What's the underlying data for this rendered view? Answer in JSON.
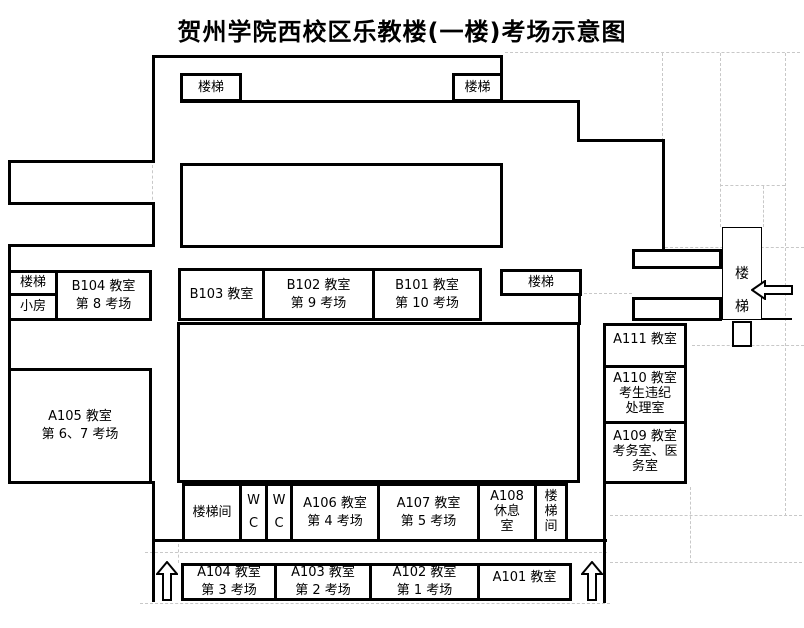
{
  "title": "贺州学院西校区乐教楼(一楼)考场示意图",
  "rooms": {
    "stair_top_left": {
      "lines": [
        "楼梯"
      ]
    },
    "stair_top_right": {
      "lines": [
        "楼梯"
      ]
    },
    "stair_left": {
      "lines": [
        "楼梯"
      ]
    },
    "small_room": {
      "lines": [
        "小房"
      ]
    },
    "b104": {
      "lines": [
        "B104 教室",
        "第 8 考场"
      ]
    },
    "b103": {
      "lines": [
        "B103 教室"
      ]
    },
    "b102": {
      "lines": [
        "B102 教室",
        "第 9 考场"
      ]
    },
    "b101": {
      "lines": [
        "B101 教室",
        "第 10 考场"
      ]
    },
    "stair_mid_right": {
      "lines": [
        "楼梯"
      ]
    },
    "a105": {
      "lines": [
        "A105 教室",
        "第 6、7 考场"
      ]
    },
    "a111": {
      "lines": [
        "A111 教室"
      ]
    },
    "a110": {
      "lines": [
        "A110 教室",
        "考生违纪",
        "处理室"
      ]
    },
    "a109": {
      "lines": [
        "A109 教室",
        "考务室、医",
        "务室"
      ]
    },
    "stair_right": {
      "lines": [
        "楼",
        "梯"
      ]
    },
    "stair_hall_left": {
      "lines": [
        "楼梯间"
      ]
    },
    "wc_1": {
      "lines": [
        "W",
        "C"
      ]
    },
    "wc_2": {
      "lines": [
        "W",
        "C"
      ]
    },
    "a106": {
      "lines": [
        "A106 教室",
        "第 4 考场"
      ]
    },
    "a107": {
      "lines": [
        "A107 教室",
        "第 5 考场"
      ]
    },
    "a108": {
      "lines": [
        "A108",
        "休息",
        "室"
      ]
    },
    "stair_hall_right": {
      "lines": [
        "楼",
        "梯",
        "间"
      ]
    },
    "a104": {
      "lines": [
        "A104 教室",
        "第 3 考场"
      ]
    },
    "a103": {
      "lines": [
        "A103 教室",
        "第 2 考场"
      ]
    },
    "a102": {
      "lines": [
        "A102 教室",
        "第 1 考场"
      ]
    },
    "a101": {
      "lines": [
        "A101 教室"
      ]
    }
  },
  "icons": {
    "up_arrow": "outline block arrow pointing up",
    "left_arrow": "outline block arrow pointing left"
  },
  "colors": {
    "background": "#ffffff",
    "wall": "#000000",
    "gridline": "#c8c8c8",
    "text": "#000000"
  }
}
